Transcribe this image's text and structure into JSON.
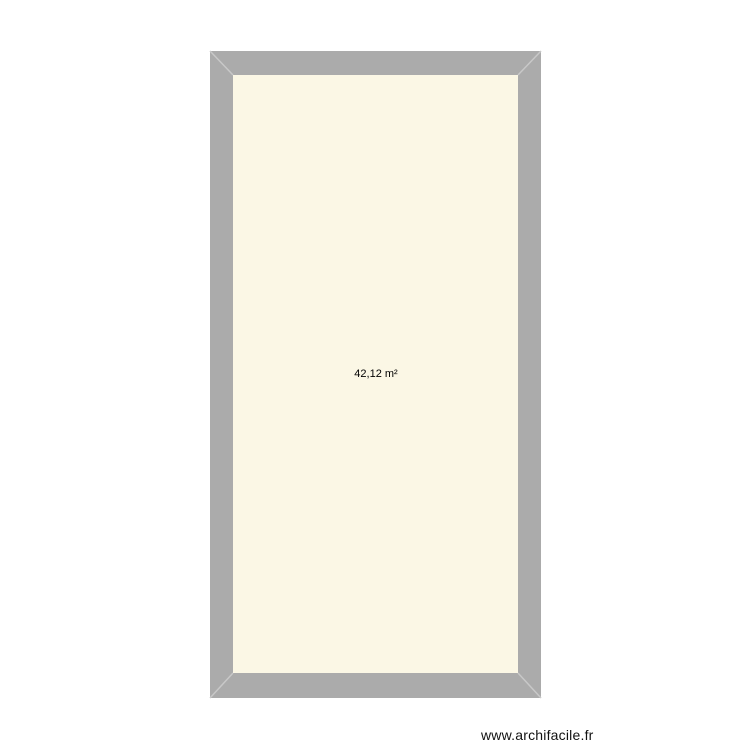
{
  "plan": {
    "room": {
      "area_label": "42,12 m²"
    },
    "colors": {
      "wall": "#ababab",
      "miter": "#c8c8c8",
      "interior": "#fbf7e5",
      "background": "#ffffff"
    }
  },
  "watermark": {
    "text": "www.archifacile.fr"
  }
}
